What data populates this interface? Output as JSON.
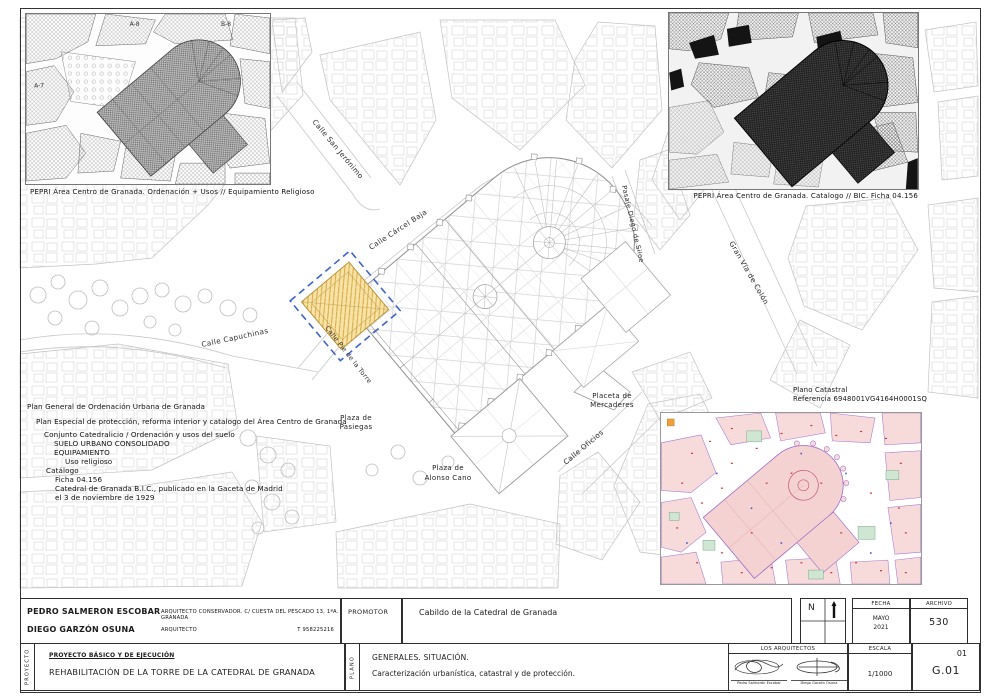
{
  "insets": {
    "top_left": {
      "caption": "PEPRI Área Centro de Granada. Ordenación + Usos // Equipamiento Religioso",
      "zone_labels": [
        "A-7",
        "A-8",
        "B-8"
      ]
    },
    "top_right": {
      "caption": "PEPRI Área Centro de Granada. Catalogo // BIC. Ficha 04.156"
    },
    "cadastral": {
      "title": "Plano Catastral",
      "reference": "Referencia 6948001VG4164H0001SQ"
    }
  },
  "planning_notes": [
    "Plan General de Ordenación Urbana de Granada",
    "Plan Especial de protección, reforma interior y catalogo del Área Centro de Granada",
    "Conjunto Catedralicio / Ordenación y usos del suelo",
    "SUELO URBANO CONSOLIDADO",
    "EQUIPAMIENTO",
    "Uso religioso",
    "Catálogo",
    "Ficha 04.156",
    "Catedral de Granada B.I.C., publicado en la Gaceta de Madrid",
    "el 3 de noviembre de 1929"
  ],
  "plan": {
    "streets": {
      "san_jeronimo": "Calle San Jerónimo",
      "carcel_baja": "Calle Cárcel Baja",
      "capuchinas": "Calle Capuchinas",
      "pie_de_la_torre": "Calle Pie de la Torre",
      "pasaje_diego_siloe": "Pasaje Diego de Siloe",
      "gran_via": "Gran Vía de Colón",
      "oficios": "Calle Oficios"
    },
    "places": {
      "pasiegas_1": "Plaza de",
      "pasiegas_2": "Pasiegas",
      "alonso_1": "Plaza de",
      "alonso_2": "Alonso Cano",
      "mercaderes_1": "Placeta  de",
      "mercaderes_2": "Mercaderes"
    }
  },
  "title_block": {
    "architect_1": {
      "name": "PEDRO SALMERON ESCOBAR",
      "role": "ARQUITECTO CONSERVADOR.  C/ CUESTA DEL PESCADO 13, 1ªA. GRANADA"
    },
    "architect_2": {
      "name": "DIEGO GARZÓN OSUNA",
      "role": "ARQUITECTO",
      "phone": "T 958225216"
    },
    "promotor": {
      "label": "PROMOTOR",
      "value": "Cabildo de la Catedral de Granada"
    },
    "north": "N",
    "fecha": {
      "label": "FECHA",
      "month": "MAYO",
      "year": "2021"
    },
    "archivo": {
      "label": "ARCHIVO",
      "value": "530"
    },
    "proyecto": {
      "side_label": "PROYECTO",
      "type": "PROYECTO BÁSICO Y DE EJECUCIÓN",
      "title": "REHABILITACIÓN DE LA TORRE DE LA CATEDRAL DE GRANADA"
    },
    "plano": {
      "side_label": "PLANO",
      "title": "GENERALES. SITUACIÓN.",
      "subtitle": "Caracterización urbanística, catastral y de protección."
    },
    "arquitectos": {
      "label": "LOS ARQUITECTOS",
      "signature_1": "Pedro Salmerón Escobar",
      "signature_2": "Diego Garzón Osuna"
    },
    "escala": {
      "label": "ESCALA",
      "value": "1/1000"
    },
    "sheet": {
      "number": "01",
      "code": "G.01"
    }
  },
  "colors": {
    "highlight_fill": "#f7e3a8",
    "highlight_hatch": "#d8a93c",
    "protection_outline": "#3d63cf",
    "cadastral_parcel": "#f7dada",
    "cadastral_line": "#9a6cc8",
    "plan_line": "#9b9b9b"
  }
}
